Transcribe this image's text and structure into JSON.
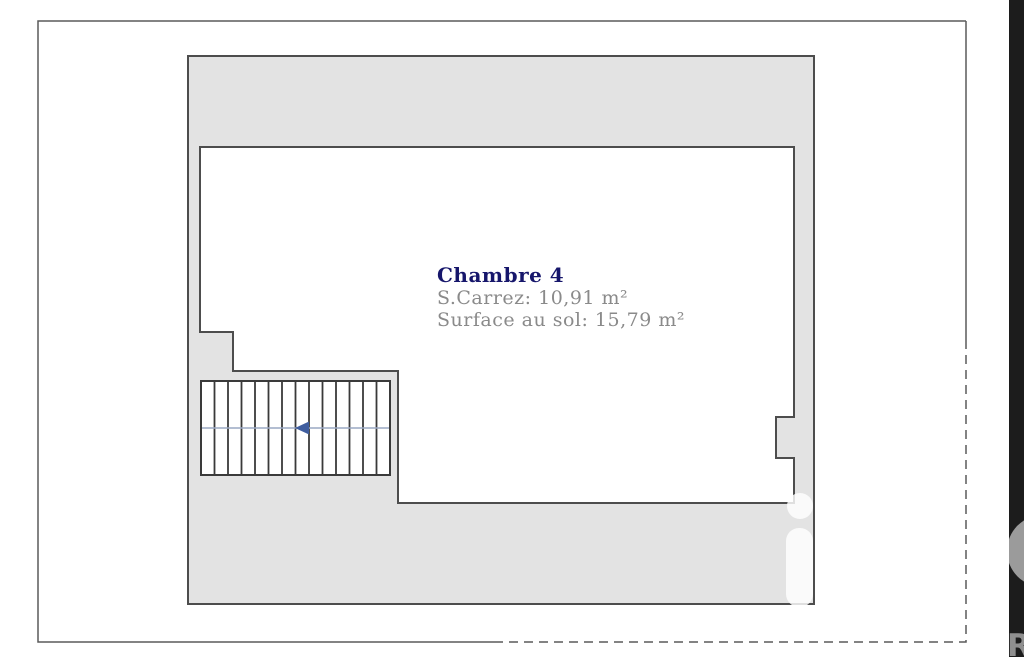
{
  "plan": {
    "room": {
      "title": "Chambre 4",
      "carrez": "S.Carrez: 10,91 m²",
      "surface": "Surface au sol: 15,79 m²"
    },
    "stairs": {
      "tread_count": 14,
      "direction": "left"
    },
    "colors": {
      "wall_fill": "#e3e3e3",
      "wall_stroke": "#4d4d4d",
      "room_fill": "#ffffff",
      "stair_stroke": "#3a3a3a",
      "stair_center_line": "#9aa8c4",
      "stair_arrow": "#3f5d9e",
      "frame_stroke": "#5a5a5a",
      "title_color": "#16166b",
      "metric_color": "#8a8a8a",
      "band_fill": "#1c1c1c",
      "band_letter_color": "#8f8f8f",
      "watermark_overlay": "rgba(255,255,255,0.82)"
    }
  },
  "watermark": {
    "band_letter": "R"
  }
}
